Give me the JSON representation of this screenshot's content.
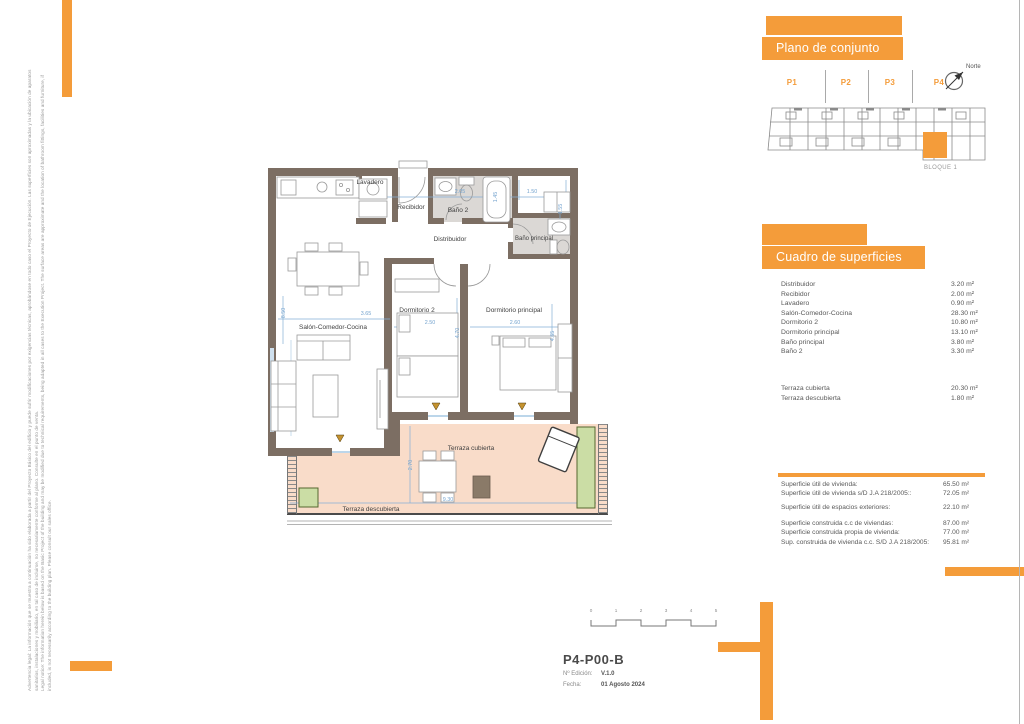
{
  "colors": {
    "accent_orange": "#F49C3A",
    "wall_brown": "#7C6E63",
    "terrace_salmon": "#F9DCC9",
    "bath_gray": "#DBD8D5",
    "dim_blue": "#74A3CE",
    "planter_green": "#CBDDA5"
  },
  "disclaimer": {
    "line1": "Advertencia legal: La información que se muestra a continuación ha sido elaborada a partir del Proyecto Básico del edificio y puede sufrir modificaciones por exigencias técnicas, aprobándose en todo caso el Proyecto de Ejecución. Las superficies son aproximadas y la ubicación de aparatos",
    "line2": "sanitarios, instalaciones y mobiliario, en tal caso de incluirse, no necesariamente conforme al plano. Consulte en el punto de venta.",
    "line3": "Legal notice: The information herein below is based on the Basic Project of the building and may be modified due to technical requirements, being adapted in all cases to the Execution Project. The surface areas are approximate and the location of bathroom fittings, facilities and furniture, if",
    "line4": "included, is not necessarily according to the building plan. Please consult our sales office."
  },
  "plano_conjunto": {
    "title": "Plano de conjunto",
    "sections": [
      {
        "label": "P1"
      },
      {
        "label": "P2"
      },
      {
        "label": "P3"
      },
      {
        "label": "P4"
      }
    ],
    "north_label": "Norte",
    "block_label": "BLOQUE 1"
  },
  "superficies": {
    "title": "Cuadro de superficies",
    "rows": [
      {
        "label": "Distribuidor",
        "value": "3.20 m²"
      },
      {
        "label": "Recibidor",
        "value": "2.00 m²"
      },
      {
        "label": "Lavadero",
        "value": "0.90 m²"
      },
      {
        "label": "Salón-Comedor-Cocina",
        "value": "28.30 m²"
      },
      {
        "label": "Dormitorio 2",
        "value": "10.80 m²"
      },
      {
        "label": "Dormitorio principal",
        "value": "13.10 m²"
      },
      {
        "label": "Baño principal",
        "value": "3.80 m²"
      },
      {
        "label": "Baño 2",
        "value": "3.30 m²"
      }
    ],
    "terrace_rows": [
      {
        "label": "Terraza cubierta",
        "value": "20.30 m²"
      },
      {
        "label": "Terraza descubierta",
        "value": "1.80 m²"
      }
    ],
    "summary_group1": [
      {
        "label": "Superficie útil de vivienda:",
        "value": "65.50 m²"
      },
      {
        "label": "Superficie útil de vivienda s/D J.A 218/2005::",
        "value": "72.05 m²"
      }
    ],
    "summary_group2": [
      {
        "label": "Superficie útil de espacios exteriores:",
        "value": "22.10 m²"
      }
    ],
    "summary_group3": [
      {
        "label": "Superficie construida c.c de viviendas:",
        "value": "87.00 m²"
      },
      {
        "label": "Superficie construida propia de vivienda:",
        "value": "77.00 m²"
      },
      {
        "label": "Sup. construida de vivienda c.c. S/D J.A 218/2005:",
        "value": "95.81 m²"
      }
    ]
  },
  "floorplan": {
    "rooms": {
      "lavadero": "Lavadero",
      "recibidor": "Recibidor",
      "bano2": "Baño 2",
      "distribuidor": "Distribuidor",
      "banop": "Baño principal",
      "salon": "Salón-Comedor-Cocina",
      "dorm2": "Dormitorio 2",
      "dormp": "Dormitorio principal",
      "terraza_cubierta": "Terraza cubierta",
      "terraza_descubierta": "Terraza descubierta"
    },
    "dimensions": {
      "bano2_width": "2.05",
      "bano2_depth": "1.45",
      "vestidor_width": "1.50",
      "vestidor_depth": "1.55",
      "salon_depth": "8.50",
      "salon_width": "3.65",
      "dorm2_width": "2.50",
      "dorm2_depth": "4.70",
      "dormp_width": "2.60",
      "dormp_depth": "4.65",
      "terraza_depth": "2.70",
      "terraza_width": "9.30"
    }
  },
  "titleblock": {
    "code": "P4-P00-B",
    "edition_label": "Nº Edición:",
    "edition_value": "V.1.0",
    "date_label": "Fecha:",
    "date_value": "01 Agosto 2024",
    "scale_ticks": [
      "0",
      "1",
      "2",
      "3",
      "4",
      "5"
    ]
  }
}
